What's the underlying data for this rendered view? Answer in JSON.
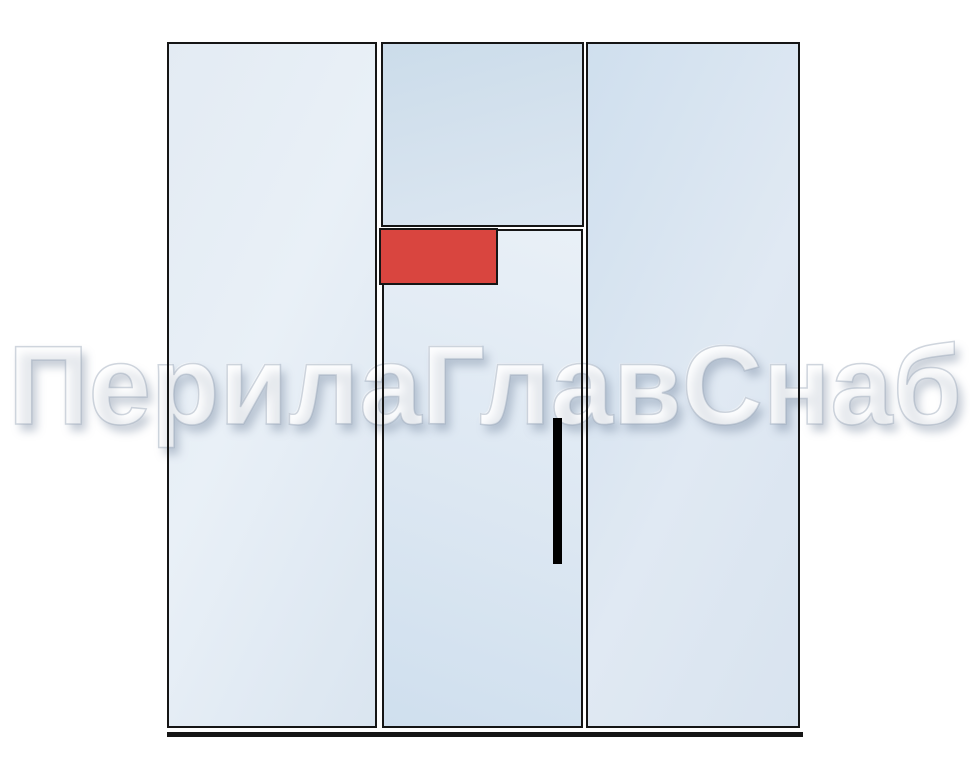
{
  "watermark": {
    "text": "ПерилаГлавСнаб"
  },
  "colors": {
    "background": "#ffffff",
    "frame_line": "#151515",
    "glass_light": "#e9f0f7",
    "glass_mid": "#dce7f2",
    "glass_deep": "#cbdcea",
    "marker_red": "#d9453f",
    "handle_black": "#000000"
  },
  "diagram": {
    "type": "glass-partition-elevation",
    "sections": [
      {
        "name": "left-fixed-panel"
      },
      {
        "name": "top-transom-panel"
      },
      {
        "name": "door-leaf-panel"
      },
      {
        "name": "right-fixed-panel"
      }
    ],
    "elements": [
      {
        "name": "red-highlight-marker"
      },
      {
        "name": "door-handle"
      },
      {
        "name": "floor-track"
      }
    ]
  }
}
